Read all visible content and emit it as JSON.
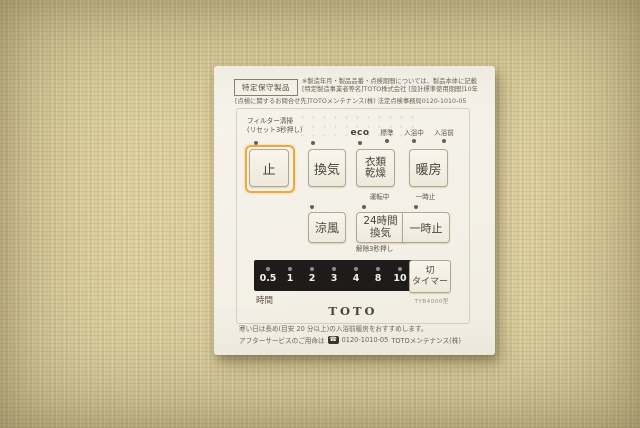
{
  "colors": {
    "accent_orange": "#efa83d",
    "panel_bg": "#f5f2ea",
    "timer_bar_bg": "#1e1c1a",
    "wallpaper": "#d9cfa2"
  },
  "panel": {
    "certification_label": "特定保守製品",
    "notice": {
      "line1": "※製造年月・製品品番・点検期間については、製品本体に記載",
      "line2": "[特定製造事業者等名]TOTO株式会社 [設計標準使用期間]10年",
      "line3": "[点検に関するお問合せ先]TOTOメンテナンス(株) 法定点検事務局0120-1010-05"
    },
    "filter_label": "フィルター清掃\n(リセット3秒押し)",
    "eco_label": "eco",
    "mode_labels": [
      "標準",
      "入浴中",
      "入浴前"
    ],
    "buttons": {
      "stop": "止",
      "ventilation": "換気",
      "clothes_drying": "衣類\n乾燥",
      "heating": "暖房",
      "cool_breeze": "涼風",
      "vent_24h": "24時間\n換気",
      "pause": "一時止",
      "timer_off": "切\nタイマー"
    },
    "status_labels": {
      "running": "運転中",
      "pause": "一時止",
      "release": "解除3秒押し"
    },
    "timer": {
      "values": [
        "0.5",
        "1",
        "2",
        "3",
        "4",
        "8",
        "10"
      ],
      "unit_label": "時間"
    },
    "model": "TYB4000型",
    "brand": "TOTO",
    "footer": {
      "line1": "寒い日は長め(目安 20 分以上)の入浴前暖房をおすすめします。",
      "line2_prefix": "アフターサービスのご用命は",
      "phone_icon": "☎",
      "phone_number": "0120-1010-05",
      "line2_suffix": "TOTOメンテナンス(株)"
    }
  }
}
